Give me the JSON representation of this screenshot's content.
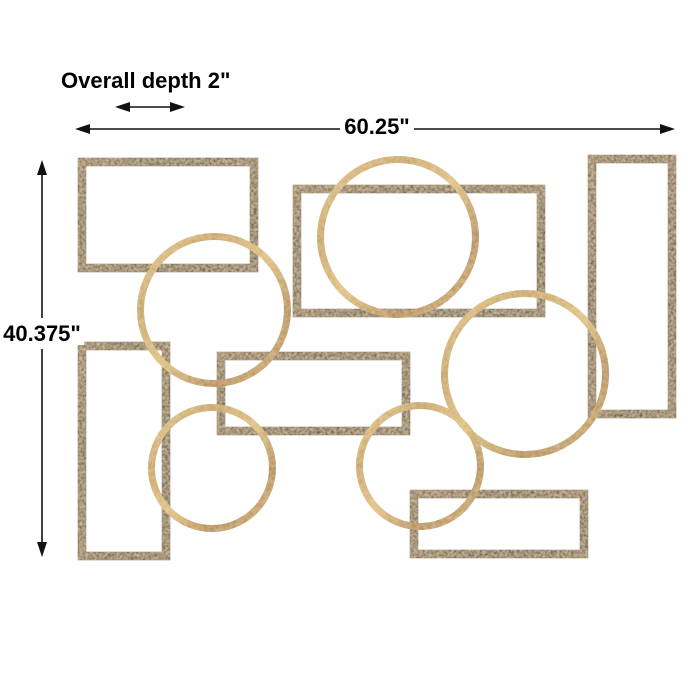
{
  "dimensions": {
    "depth_label": "Overall depth 2\"",
    "width_label": "60.25\"",
    "height_label": "40.375\""
  },
  "artwork": {
    "bronze_rectangle_count": 6,
    "gold_circle_count": 5,
    "colors": {
      "bronze": "#4a3826",
      "gold": "#c9a25d",
      "dimension_lines": "#000000",
      "background": "#ffffff"
    }
  }
}
